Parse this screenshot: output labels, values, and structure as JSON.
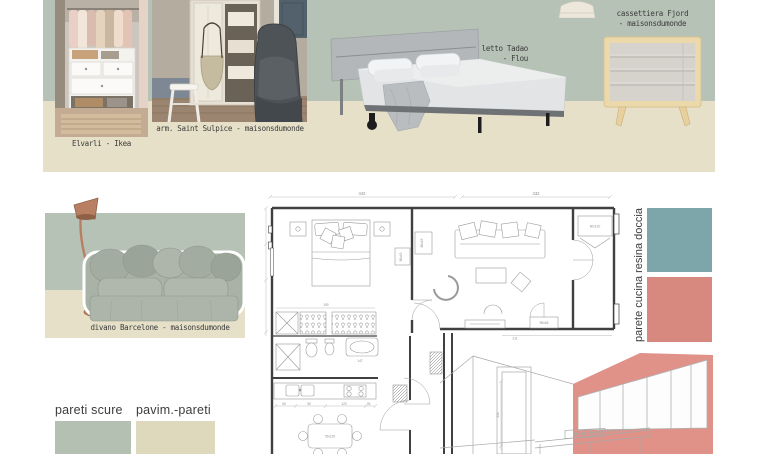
{
  "moodboard_top": {
    "wardrobe_caption": "Elvarli - Ikea",
    "armoire_caption": "arm. Saint Sulpice - maisonsdumonde",
    "bed_caption_line1": "letto Tadao",
    "bed_caption_line2": "- Flou",
    "dresser_caption_line1": "cassettiera Fjord",
    "dresser_caption_line2": "- maisonsdumonde",
    "board_green_hex": "#b6c2b6",
    "board_beige_hex": "#e6e0c8"
  },
  "moodboard_sofa": {
    "sofa_caption": "divano Barcelone - maisonsdumonde"
  },
  "palette": {
    "wall_label_vertical": "parete cucina resina doccia",
    "teal_hex": "#7ca6a9",
    "coral_hex": "#d7897f",
    "sketch_coral_hex": "#e09289",
    "swatch_bottom_left_label": "pareti scure",
    "swatch_bottom_left_hex": "#b4c0b2",
    "swatch_bottom_right_label": "pavim.-pareti",
    "swatch_bottom_right_hex": "#ded8bd"
  },
  "floorplan": {
    "dim_top_left": "442",
    "dim_top_right": "432",
    "dim_closet": "190",
    "dim_bath": "147",
    "dim_hall_bottom": "211",
    "dim_corridor_vertical": "240",
    "kitchen_dims": [
      "50",
      "90",
      "120",
      "51"
    ],
    "table_label": "76x120",
    "hall_closet_label": "60x120",
    "console_label": "95x45",
    "shelf_label_living": "80x45",
    "shelf_label_bedroom": "80x45"
  }
}
